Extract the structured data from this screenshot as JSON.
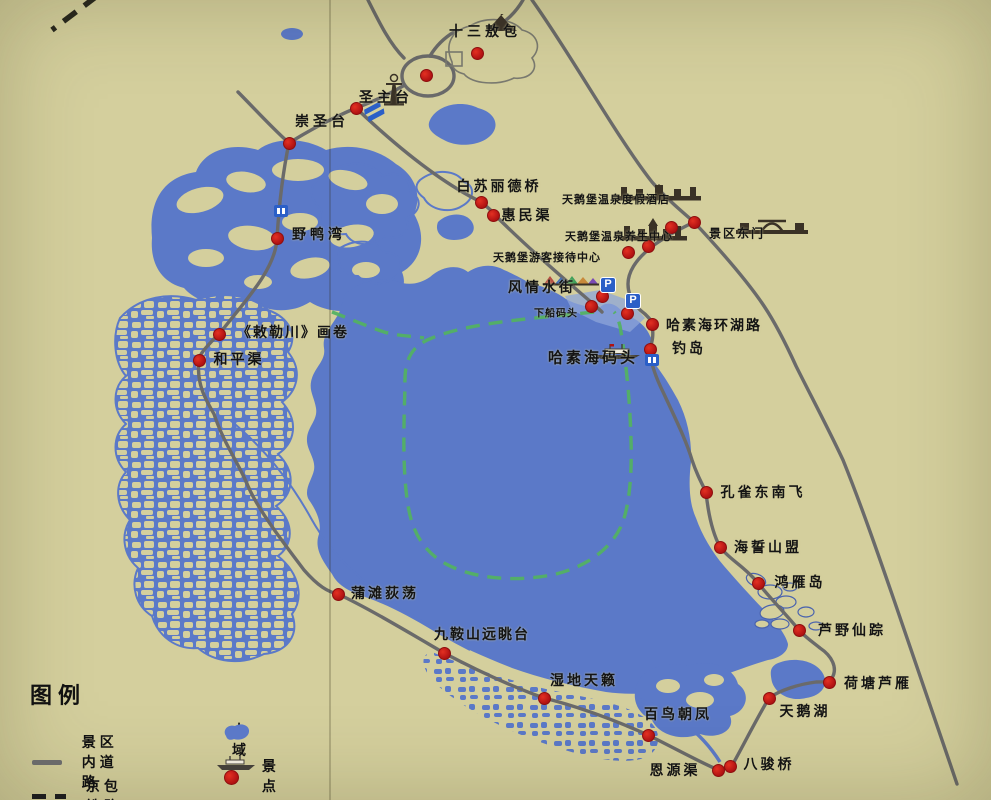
{
  "legend": {
    "title": "图例",
    "items": [
      {
        "label": "景区内道路",
        "icon": "solid-road-line"
      },
      {
        "label": "京包铁路",
        "icon": "dashed-railway-line"
      },
      {
        "label": "水域",
        "icon": "water-area"
      },
      {
        "label": "景点",
        "icon": "scenic-spot"
      }
    ]
  },
  "colors": {
    "background": "#d4cf9d",
    "water": "#5b79c8",
    "road": "#6a6a6a",
    "boat_route_green": "#53b163",
    "scenic_dot_red": "#c81e1e",
    "railway_black": "#26261e",
    "facility_blue": "#2b5fc7",
    "text": "#141414"
  },
  "pois": [
    {
      "id": "shisan-aobao",
      "label": "十三敖包",
      "dot": [
        477,
        53
      ],
      "label_c": [
        485,
        31
      ],
      "fs": 14,
      "ls": 4,
      "icon": "aobao",
      "icon_c": [
        481,
        14
      ]
    },
    {
      "id": "shengzhutai",
      "label": "圣主台",
      "dot": [
        426,
        75
      ],
      "label_c": [
        386,
        97
      ],
      "fs": 14,
      "ls": 4,
      "icon": "pagoda",
      "icon_c": [
        381,
        73
      ]
    },
    {
      "id": "chongshengtai",
      "label": "崇圣台",
      "dot": [
        289,
        143
      ],
      "label_c": [
        322,
        121
      ],
      "fs": 14,
      "ls": 4
    },
    {
      "id": "baisulide-bridge",
      "label": "白苏丽德桥",
      "dot": [
        481,
        202
      ],
      "label_c": [
        499,
        186
      ],
      "fs": 14,
      "ls": 3
    },
    {
      "id": "huimin-canal",
      "label": "惠民渠",
      "dot": [
        493,
        215
      ],
      "label_c": [
        527,
        215
      ],
      "fs": 14,
      "ls": 3
    },
    {
      "id": "tianebao-hotel",
      "label": "天鹅堡温泉度假酒店",
      "dot": [
        671,
        227
      ],
      "label_c": [
        616,
        199
      ],
      "fs": 11,
      "ls": 1,
      "icon": "castle-wide",
      "icon_c": [
        616,
        184
      ]
    },
    {
      "id": "wellness-center",
      "label": "天鹅堡温泉养生中心",
      "dot": [
        648,
        246
      ],
      "label_c": [
        619,
        236
      ],
      "fs": 11,
      "ls": 1,
      "icon": "castle",
      "icon_c": [
        618,
        217
      ]
    },
    {
      "id": "visitor-center",
      "label": "天鹅堡游客接待中心",
      "dot": [
        628,
        252
      ],
      "label_c": [
        547,
        257
      ],
      "fs": 11,
      "ls": 1
    },
    {
      "id": "east-gate",
      "label": "景区东门",
      "dot": [
        694,
        222
      ],
      "label_c": [
        737,
        233
      ],
      "fs": 12,
      "ls": 2,
      "icon": "gate",
      "icon_c": [
        735,
        215
      ]
    },
    {
      "id": "fengqing-street",
      "label": "风情水街",
      "dot": [
        602,
        296
      ],
      "label_c": [
        542,
        287
      ],
      "fs": 14,
      "ls": 3,
      "icon": "street",
      "icon_c": [
        542,
        273
      ]
    },
    {
      "id": "xiachuan-dock",
      "label": "下船码头",
      "dot": [
        591,
        306
      ],
      "label_c": [
        556,
        312
      ],
      "fs": 10,
      "ls": 1
    },
    {
      "id": "huanhu-road",
      "label": "哈素海环湖路",
      "dot": [
        652,
        324
      ],
      "label_c": [
        714,
        325
      ],
      "fs": 14,
      "ls": 2
    },
    {
      "id": "diao-island",
      "label": "钓岛",
      "dot": [
        650,
        349
      ],
      "label_c": [
        689,
        348
      ],
      "fs": 14,
      "ls": 3
    },
    {
      "id": "hasuhai-dock",
      "label": "哈素海码头",
      "dot": null,
      "label_c": [
        593,
        357
      ],
      "fs": 15,
      "ls": 3,
      "icon": "ship",
      "icon_c": [
        592,
        343
      ]
    },
    {
      "id": "chilechuan-scroll",
      "label": "《敕勒川》画卷",
      "dot": [
        219,
        334
      ],
      "label_c": [
        293,
        332
      ],
      "fs": 14,
      "ls": 2
    },
    {
      "id": "heping-canal",
      "label": "和平渠",
      "dot": [
        199,
        360
      ],
      "label_c": [
        239,
        359
      ],
      "fs": 14,
      "ls": 3
    },
    {
      "id": "yeyawan",
      "label": "野鸭湾",
      "dot": [
        277,
        238
      ],
      "label_c": [
        319,
        234
      ],
      "fs": 14,
      "ls": 4
    },
    {
      "id": "kongque-dongnanfei",
      "label": "孔雀东南飞",
      "dot": [
        706,
        492
      ],
      "label_c": [
        763,
        492
      ],
      "fs": 14,
      "ls": 3
    },
    {
      "id": "haishi-shanmeng",
      "label": "海誓山盟",
      "dot": [
        720,
        547
      ],
      "label_c": [
        768,
        547
      ],
      "fs": 14,
      "ls": 3
    },
    {
      "id": "hongyan-island",
      "label": "鸿雁岛",
      "dot": [
        758,
        583
      ],
      "label_c": [
        800,
        582
      ],
      "fs": 14,
      "ls": 3
    },
    {
      "id": "luye-xianzong",
      "label": "芦野仙踪",
      "dot": [
        799,
        630
      ],
      "label_c": [
        852,
        630
      ],
      "fs": 14,
      "ls": 3
    },
    {
      "id": "hetang-luyan",
      "label": "荷塘芦雁",
      "dot": [
        829,
        682
      ],
      "label_c": [
        878,
        683
      ],
      "fs": 14,
      "ls": 3
    },
    {
      "id": "swan-lake",
      "label": "天鹅湖",
      "dot": [
        769,
        698
      ],
      "label_c": [
        805,
        711
      ],
      "fs": 14,
      "ls": 3
    },
    {
      "id": "bainiao-chaofeng",
      "label": "百鸟朝凤",
      "dot": [
        648,
        735
      ],
      "label_c": [
        678,
        714
      ],
      "fs": 14,
      "ls": 3
    },
    {
      "id": "enyuan-canal",
      "label": "恩源渠",
      "dot": [
        718,
        770
      ],
      "label_c": [
        675,
        770
      ],
      "fs": 14,
      "ls": 3
    },
    {
      "id": "bajun-bridge",
      "label": "八骏桥",
      "dot": [
        730,
        766
      ],
      "label_c": [
        769,
        764
      ],
      "fs": 14,
      "ls": 3
    },
    {
      "id": "putan-didang",
      "label": "蒲滩荻荡",
      "dot": [
        338,
        594
      ],
      "label_c": [
        385,
        593
      ],
      "fs": 14,
      "ls": 3
    },
    {
      "id": "jiuanshan-lookout",
      "label": "九鞍山远眺台",
      "dot": [
        444,
        653
      ],
      "label_c": [
        482,
        634
      ],
      "fs": 14,
      "ls": 2
    },
    {
      "id": "shidi-tianlai",
      "label": "湿地天籁",
      "dot": [
        544,
        698
      ],
      "label_c": [
        584,
        680
      ],
      "fs": 14,
      "ls": 3
    }
  ],
  "extra_dots": [
    [
      356,
      108
    ],
    [
      627,
      313
    ]
  ],
  "facilities": [
    {
      "type": "parking-icon",
      "x": 608,
      "y": 285,
      "text": "P"
    },
    {
      "type": "parking-icon",
      "x": 633,
      "y": 301,
      "text": "P"
    },
    {
      "type": "wc-icon",
      "x": 281,
      "y": 211
    },
    {
      "type": "dock-sign-icon",
      "x": 652,
      "y": 360
    },
    {
      "type": "parking-lot-icon",
      "x": 376,
      "y": 112
    }
  ]
}
